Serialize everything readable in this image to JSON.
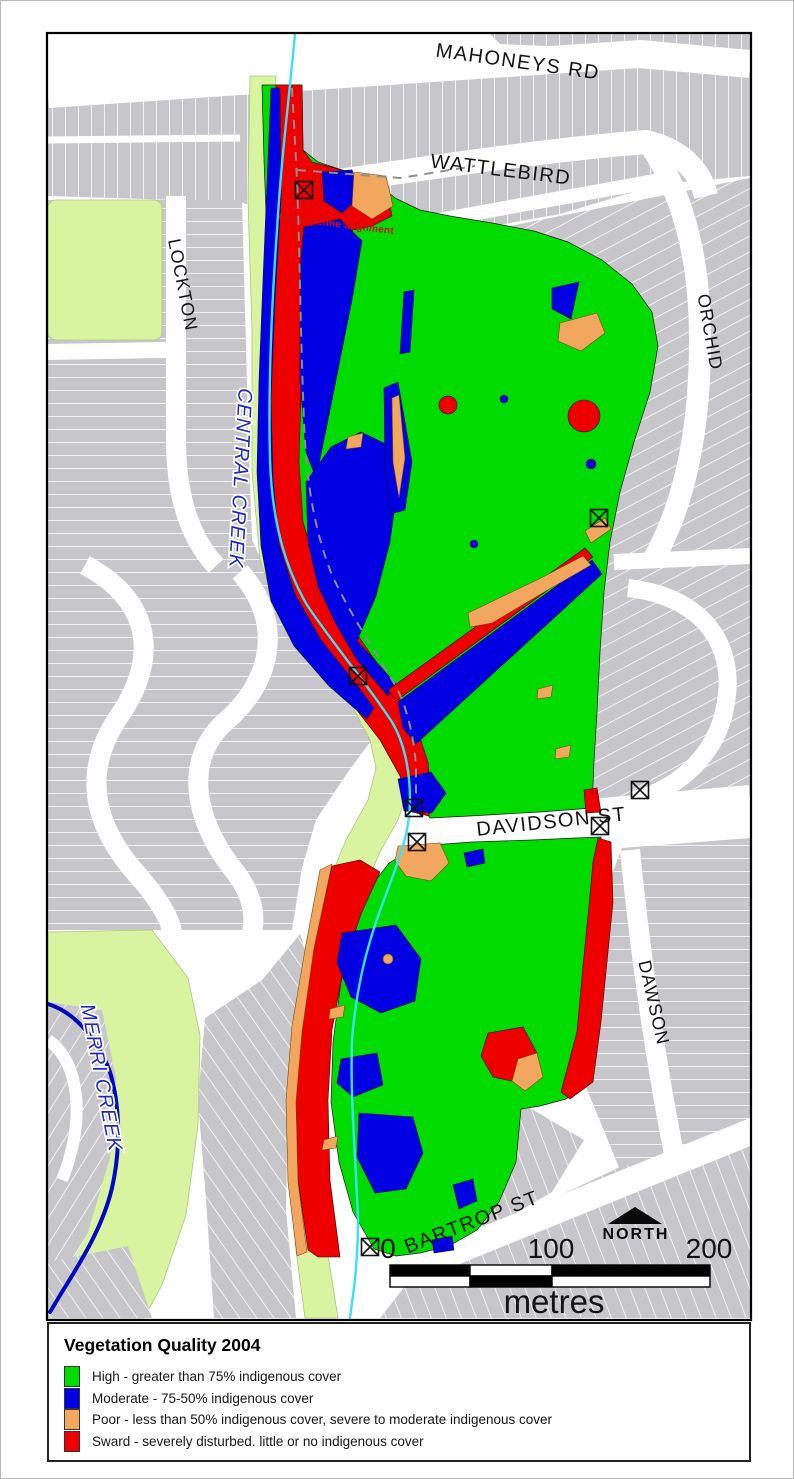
{
  "map": {
    "colors": {
      "high": "#00DC00",
      "moderate": "#0000E2",
      "poor": "#F2A75F",
      "sward": "#EE0000",
      "parkland": "#D9F4A1",
      "urban": "#C7C7CB",
      "street": "#FFFFFF",
      "central_creek": "#38E2F5",
      "merri_creek": "#0009C0",
      "pipeline": "#8E8E8E",
      "water_label": "#2128BE",
      "annotation": "#D01010"
    },
    "labels": {
      "mahoneys_rd": "MAHONEYS RD",
      "wattlebird": "WATTLEBIRD",
      "lockton": "LOCKTON",
      "orchid": "ORCHID",
      "central_creek": "CENTRAL CREEK",
      "davidson_st": "DAVIDSON ST",
      "dawson": "DAWSON",
      "merri_creek": "MERRI CREEK",
      "bartrop_st": "BARTROP ST",
      "gas_pipeline": "Gas pipeline alignment"
    },
    "markers": [
      [
        304,
        190
      ],
      [
        599,
        518
      ],
      [
        358,
        676
      ],
      [
        414,
        808
      ],
      [
        417,
        842
      ],
      [
        640,
        790
      ],
      [
        600,
        826
      ],
      [
        370,
        1247
      ]
    ]
  },
  "north": {
    "label": "NORTH"
  },
  "scale": {
    "t0": "0",
    "t100": "100",
    "t200": "200",
    "unit": "metres"
  },
  "legend": {
    "title": "Vegetation Quality 2004",
    "items": [
      {
        "key": "high",
        "label": "High - greater than 75% indigenous cover"
      },
      {
        "key": "moderate",
        "label": "Moderate - 75-50% indigenous cover"
      },
      {
        "key": "poor",
        "label": "Poor - less than 50% indigenous cover, severe to moderate indigenous cover"
      },
      {
        "key": "sward",
        "label": "Sward - severely disturbed. little or no indigenous cover"
      }
    ]
  }
}
